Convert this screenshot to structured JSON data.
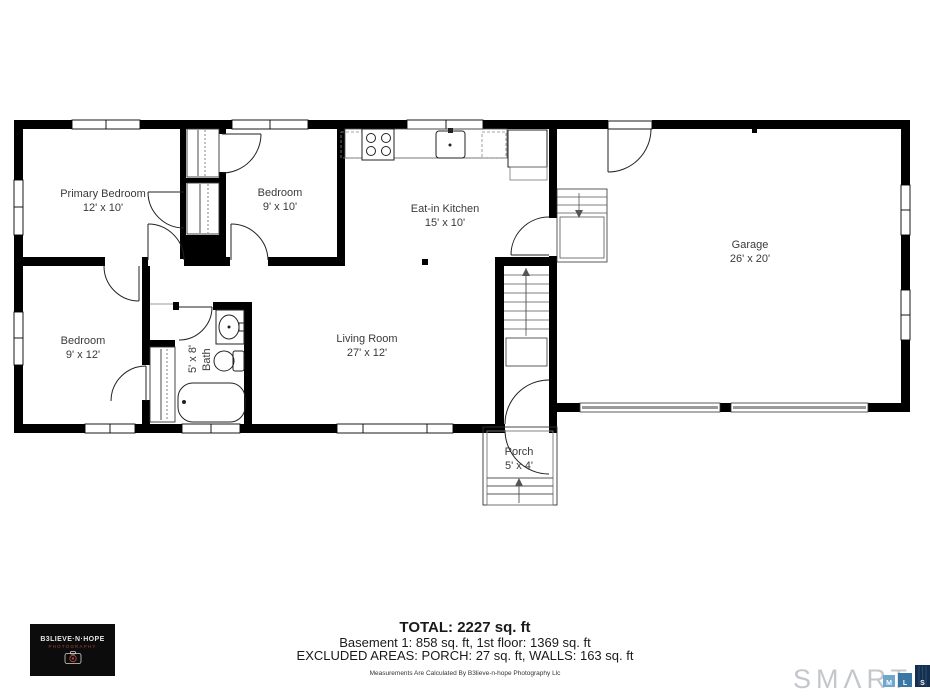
{
  "colors": {
    "walls": "#000000",
    "labels": "#3a3a3a",
    "smart_gray": "#c3c7cb",
    "logo_bg": "#0c0c0c",
    "mls_m_blue": "#6fa7cf",
    "mls_l_blue": "#3a77a6",
    "mls_s_navy": "#14304e"
  },
  "rooms": {
    "primary_bedroom": {
      "name": "Primary Bedroom",
      "dims": "12' x 10'"
    },
    "bedroom_9x10": {
      "name": "Bedroom",
      "dims": "9' x 10'"
    },
    "kitchen": {
      "name": "Eat-in Kitchen",
      "dims": "15' x 10'"
    },
    "garage": {
      "name": "Garage",
      "dims": "26' x 20'"
    },
    "bedroom_9x12": {
      "name": "Bedroom",
      "dims": "9' x 12'"
    },
    "bath": {
      "name": "Bath",
      "dims": "5' x 8'"
    },
    "living_room": {
      "name": "Living Room",
      "dims": "27' x 12'"
    },
    "porch": {
      "name": "Porch",
      "dims": "5' x 4'"
    }
  },
  "summary": {
    "total": "TOTAL: 2227 sq. ft",
    "floors": "Basement 1: 858 sq. ft, 1st floor: 1369 sq. ft",
    "excluded": "EXCLUDED AREAS: PORCH: 27 sq. ft, WALLS: 163 sq. ft",
    "disclaimer": "Measurements Are Calculated By B3lieve-n-hope Photography Llc"
  },
  "branding": {
    "photographer": {
      "line1": "B3LIEVE·N·HOPE",
      "line2": "PHOTOGRAPHY"
    },
    "mls": {
      "wordmark": "SMΛRT",
      "squares": [
        {
          "letter": "M",
          "color": "#6fa7cf"
        },
        {
          "letter": "L",
          "color": "#3a77a6"
        },
        {
          "letter": "S",
          "color": "#14304e"
        }
      ]
    }
  }
}
